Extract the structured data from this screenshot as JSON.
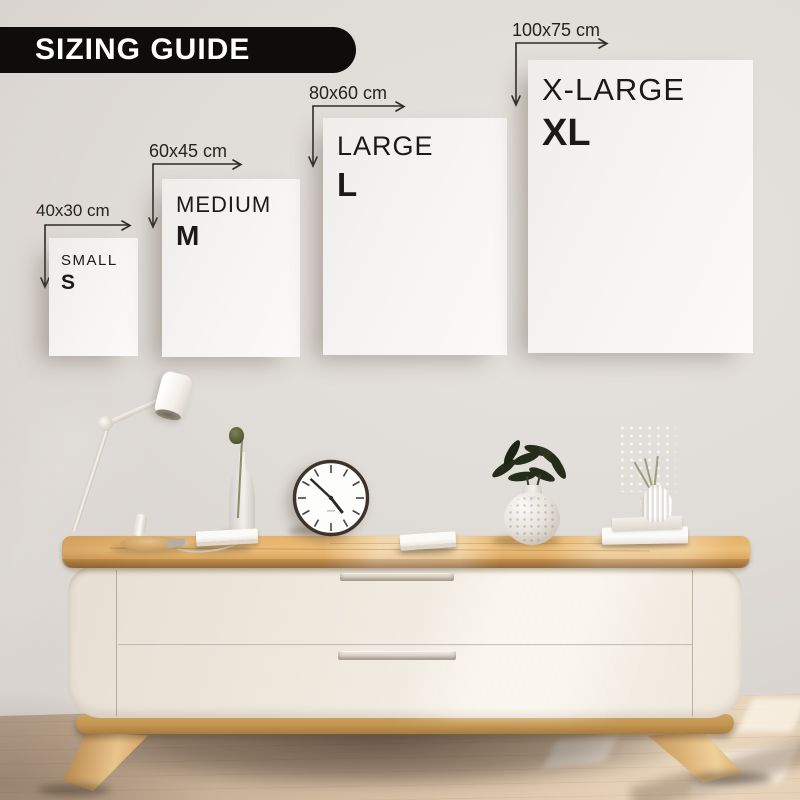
{
  "banner": {
    "title": "SIZING GUIDE"
  },
  "frames": [
    {
      "dimension": "40x30 cm",
      "name": "SMALL",
      "letter": "S"
    },
    {
      "dimension": "60x45 cm",
      "name": "MEDIUM",
      "letter": "M"
    },
    {
      "dimension": "80x60 cm",
      "name": "LARGE",
      "letter": "L"
    },
    {
      "dimension": "100x75 cm",
      "name": "X-LARGE",
      "letter": "XL"
    }
  ],
  "colors": {
    "banner_bg": "#0e0d0b",
    "banner_text": "#ffffff",
    "frame_border": "#211f1c",
    "paper": "#f7f5f2",
    "label_text": "#26241f",
    "wall": "#dedad5",
    "wood": "#e4b169",
    "cabinet_body": "#f0eae0",
    "floor": "#d4bca2"
  }
}
